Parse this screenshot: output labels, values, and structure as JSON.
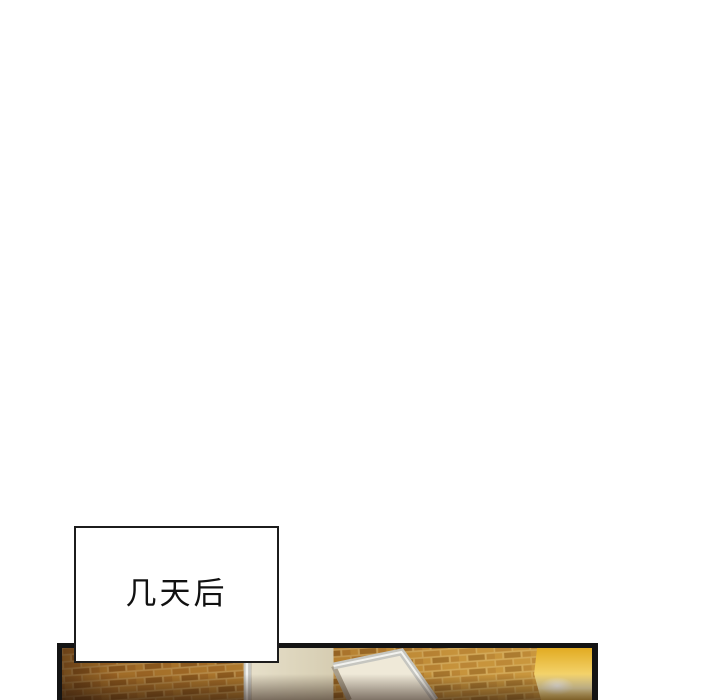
{
  "page": {
    "kind": "webtoon-page",
    "background": "#ffffff"
  },
  "caption": {
    "text": "几天后"
  },
  "panel": {
    "description": "brick wall with open door frame and warm glow, cropped at page bottom"
  },
  "theme": {
    "panel-border": "#141414",
    "caption-bg": "#ffffff",
    "caption-border": "#1c1c1c",
    "mortar": "#c9a05e",
    "brick": "#a86f2b",
    "brick2": "#b98234",
    "brick3": "#8d5a20",
    "tint-left": "#6b3c0e",
    "tint-mid": "#9a6a20",
    "tint-right": "#e7bc4e",
    "pillar": "#e6dfc9",
    "pillar-shadow": "#d6cdb2",
    "door": "#efe9d8",
    "frame-silver": "#c6c6c0",
    "frame-highlight": "#f2f2ee",
    "gap-shadow": "#a99f8c",
    "glow-top": "#e2ab22",
    "glow-mid": "#f3d26a",
    "glow-pale": "#f9ecb4",
    "glow-bottom": "#eec14f",
    "shadow-dark": "#23120a"
  }
}
